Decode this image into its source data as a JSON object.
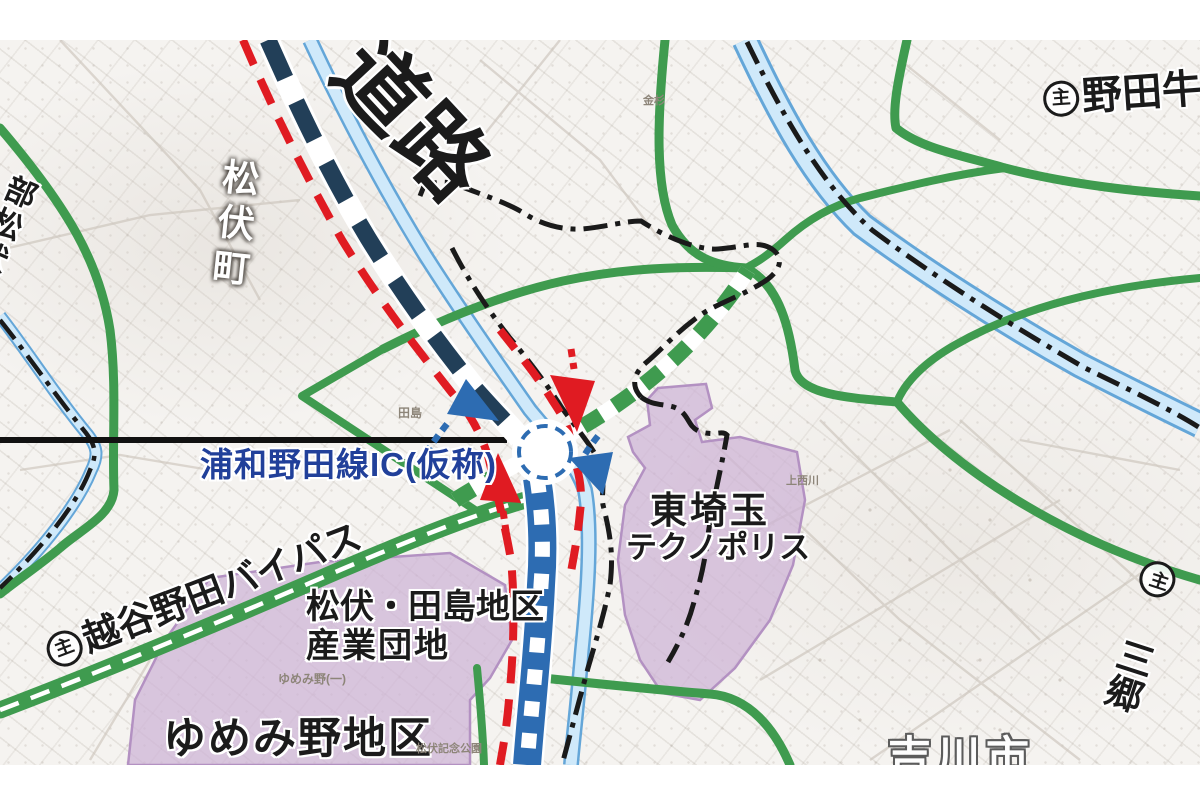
{
  "title": {
    "expressway": "道路"
  },
  "admin": {
    "matsubushi_town": "松伏町",
    "yoshikawa_city": "吉川市"
  },
  "routes": {
    "kasukabe_matsubushi": "部松伏線",
    "noda_ushiku": {
      "marker": "主",
      "name": "野田牛久"
    },
    "misato": {
      "marker": "主",
      "name": "三郷"
    },
    "koshigaya_noda_bypass": {
      "marker": "主",
      "name": "越谷野田バイパス"
    }
  },
  "interchange": {
    "label": "浦和野田線IC(仮称)"
  },
  "districts": {
    "tajima_line1": "松伏・田島地区",
    "tajima_line2": "産業団地",
    "yumemino": "ゆめみ野地区",
    "technopolis_line1": "東埼玉",
    "technopolis_line2": "テクノポリス"
  },
  "base_map_labels": {
    "kanasugi": "金杉",
    "tajima": "田島",
    "yumemino_1": "ゆめみ野(一)",
    "matsubushi_park": "松伏記念公園",
    "kaminishikawa": "上西川"
  },
  "colors": {
    "green": "#3f9b4f",
    "river_fill": "#cfe9fa",
    "river_edge": "#64a6d8",
    "navy": "#223f58",
    "blue": "#2d6cb2",
    "red": "#e01b22",
    "purple_fill": "#cdb3d6",
    "purple_edge": "#b391c2",
    "boundary_black": "#1a1a1a",
    "ic_text_blue": "#21409a"
  }
}
